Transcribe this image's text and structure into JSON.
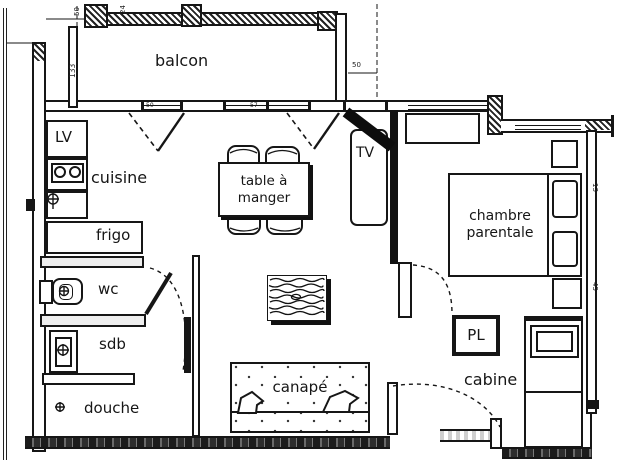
{
  "title": "apartment floor plan",
  "rooms": {
    "balcony": "balcon",
    "kitchen": "cuisine",
    "dishwasher": "LV",
    "fridge": "frigo",
    "wc": "wc",
    "bathroom": "sdb",
    "shower": "douche",
    "dining_table": "table à\nmanger",
    "tv": "TV",
    "master_bedroom": "chambre\nparentale",
    "closet": "PL",
    "cabin": "cabine",
    "sofa": "canapé"
  },
  "dimensions": {
    "balcony_depth": "133",
    "balcony_end_width": "50",
    "top_left_tick_a": "50",
    "top_left_tick_b": "24",
    "top_wall_tick_a": "50",
    "top_wall_tick_b": "57",
    "right_wall_upper": "13",
    "right_wall_lower": "45"
  },
  "colors": {
    "ink": "#161616",
    "paper": "#ffffff"
  }
}
